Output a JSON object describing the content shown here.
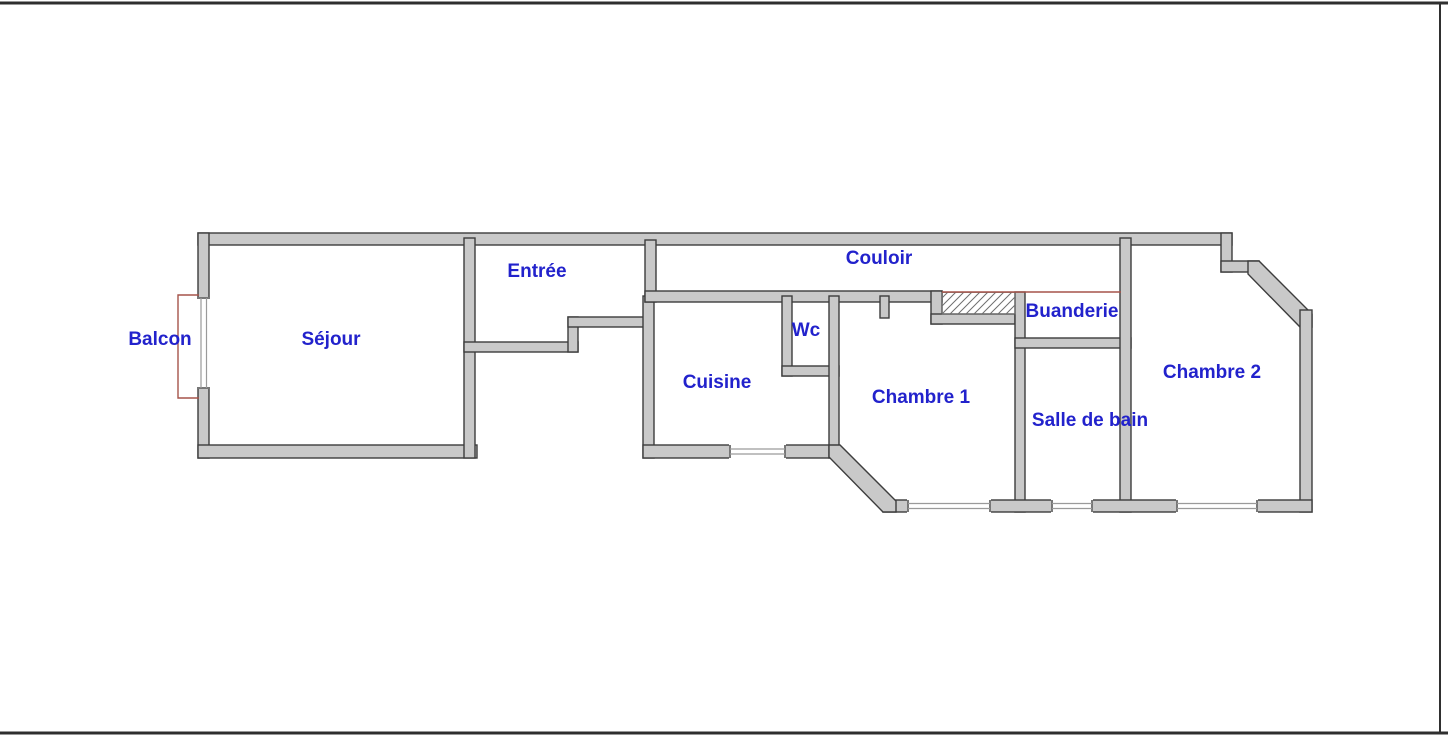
{
  "page": {
    "background": "#ffffff",
    "frame_border_color": "#2f2f2f"
  },
  "plan": {
    "type": "apartment-floor-plan",
    "wall_fill": "#c9c9c9",
    "wall_stroke": "#3d3d3d",
    "label_color": "#2222cc",
    "red_accent": "#a6544a",
    "glazing_color": "#9a9a9a",
    "rooms": [
      {
        "id": "balcon",
        "label": "Balcon"
      },
      {
        "id": "sejour",
        "label": "Séjour"
      },
      {
        "id": "entree",
        "label": "Entrée"
      },
      {
        "id": "couloir",
        "label": "Couloir"
      },
      {
        "id": "cuisine",
        "label": "Cuisine"
      },
      {
        "id": "wc",
        "label": "Wc"
      },
      {
        "id": "chambre1",
        "label": "Chambre 1"
      },
      {
        "id": "buanderie",
        "label": "Buanderie"
      },
      {
        "id": "salle_de_bain",
        "label": "Salle de bain"
      },
      {
        "id": "chambre2",
        "label": "Chambre 2"
      }
    ]
  }
}
